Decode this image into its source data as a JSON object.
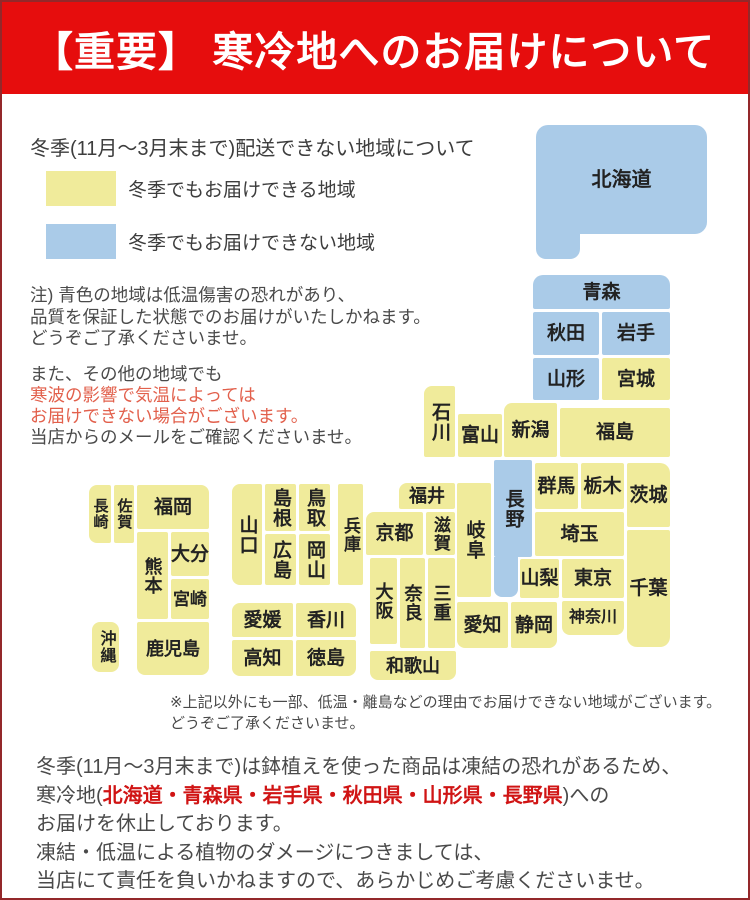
{
  "page": {
    "bg": "#ffffff",
    "border_color": "#93282a"
  },
  "banner": {
    "text": "【重要】 寒冷地へのお届けについて",
    "bg": "#e60d0d",
    "fg": "#ffffff"
  },
  "intro_title": "冬季(11月〜3月末まで)配送できない地域について",
  "legend": {
    "items": [
      {
        "color": "#f0eb9b",
        "label": "冬季でもお届けできる地域"
      },
      {
        "color": "#aacbe8",
        "label": "冬季でもお届けできない地域"
      }
    ]
  },
  "note_quality": {
    "lines": [
      {
        "parts": [
          {
            "t": "注) 青色の地域は低温傷害の恐れがあり、"
          }
        ]
      },
      {
        "parts": [
          {
            "t": "品質を保証した状態でのお届けがいたしかねます。"
          }
        ]
      },
      {
        "parts": [
          {
            "t": "どうぞご了承くださいませ。"
          }
        ]
      }
    ]
  },
  "note_coldwave": {
    "em_color": "#e2604c",
    "lines": [
      {
        "parts": [
          {
            "t": "また、その他の地域でも"
          }
        ]
      },
      {
        "parts": [
          {
            "t": "寒波の影響で気温によっては",
            "em": true
          }
        ]
      },
      {
        "parts": [
          {
            "t": "お届けできない場合がございます。",
            "em": true
          }
        ]
      },
      {
        "parts": [
          {
            "t": "当店からのメールをご確認くださいませ。"
          }
        ]
      }
    ]
  },
  "map": {
    "status_colors": {
      "ok": "#f0eb9b",
      "no": "#aacbe8"
    },
    "label_color": "#222222",
    "legend_meaning": {
      "ok": "冬季でもお届けできる地域",
      "no": "冬季でもお届けできない地域"
    },
    "blocks": [
      {
        "name": "hokkaido",
        "label": "北海道",
        "status": "no",
        "x": 534,
        "y": 123,
        "w": 171,
        "h": 109,
        "f": 20,
        "r": "12px"
      },
      {
        "name": "hokkaido-foot",
        "label": "",
        "status": "no",
        "x": 534,
        "y": 190,
        "w": 44,
        "h": 67,
        "r": "0 0 10px 10px"
      },
      {
        "name": "aomori",
        "label": "青森",
        "status": "no",
        "x": 531,
        "y": 273,
        "w": 137,
        "h": 34,
        "r": "10px 10px 2px 2px"
      },
      {
        "name": "akita",
        "label": "秋田",
        "status": "no",
        "x": 531,
        "y": 310,
        "w": 66,
        "h": 43
      },
      {
        "name": "iwate",
        "label": "岩手",
        "status": "no",
        "x": 600,
        "y": 310,
        "w": 68,
        "h": 43
      },
      {
        "name": "yamagata",
        "label": "山形",
        "status": "no",
        "x": 531,
        "y": 356,
        "w": 66,
        "h": 42
      },
      {
        "name": "miyagi",
        "label": "宮城",
        "status": "ok",
        "x": 600,
        "y": 356,
        "w": 68,
        "h": 42
      },
      {
        "name": "niigata",
        "label": "新潟",
        "status": "ok",
        "x": 502,
        "y": 401,
        "w": 53,
        "h": 54,
        "r": "8px 2px 2px 2px"
      },
      {
        "name": "fukushima",
        "label": "福島",
        "status": "ok",
        "x": 558,
        "y": 406,
        "w": 110,
        "h": 49
      },
      {
        "name": "toyama",
        "label": "富山",
        "status": "ok",
        "x": 456,
        "y": 412,
        "w": 44,
        "h": 43
      },
      {
        "name": "ishikawa",
        "label": "石川",
        "status": "ok",
        "x": 422,
        "y": 384,
        "w": 31,
        "h": 71,
        "v": true,
        "r": "8px 2px 2px 2px"
      },
      {
        "name": "gunma",
        "label": "群馬",
        "status": "ok",
        "x": 533,
        "y": 461,
        "w": 43,
        "h": 46
      },
      {
        "name": "tochigi",
        "label": "栃木",
        "status": "ok",
        "x": 579,
        "y": 461,
        "w": 43,
        "h": 46
      },
      {
        "name": "ibaraki",
        "label": "茨城",
        "status": "ok",
        "x": 625,
        "y": 461,
        "w": 43,
        "h": 64,
        "r": "2px 10px 2px 2px"
      },
      {
        "name": "saitama",
        "label": "埼玉",
        "status": "ok",
        "x": 533,
        "y": 510,
        "w": 89,
        "h": 44
      },
      {
        "name": "chiba",
        "label": "千葉",
        "status": "ok",
        "x": 625,
        "y": 528,
        "w": 43,
        "h": 117,
        "r": "2px 2px 10px 10px"
      },
      {
        "name": "yamanashi",
        "label": "山梨",
        "status": "ok",
        "x": 518,
        "y": 557,
        "w": 39,
        "h": 39
      },
      {
        "name": "tokyo",
        "label": "東京",
        "status": "ok",
        "x": 560,
        "y": 557,
        "w": 62,
        "h": 39
      },
      {
        "name": "kanagawa",
        "label": "神奈川",
        "status": "ok",
        "x": 560,
        "y": 599,
        "w": 62,
        "h": 34,
        "f": 16,
        "r": "2px 2px 8px 8px"
      },
      {
        "name": "nagano",
        "label": "長野",
        "status": "no",
        "x": 492,
        "y": 458,
        "w": 38,
        "h": 97,
        "v": true
      },
      {
        "name": "nagano-south",
        "label": "",
        "status": "no",
        "x": 492,
        "y": 555,
        "w": 24,
        "h": 40,
        "r": "0 0 8px 8px"
      },
      {
        "name": "gifu",
        "label": "岐阜",
        "status": "ok",
        "x": 455,
        "y": 481,
        "w": 34,
        "h": 114,
        "v": true
      },
      {
        "name": "fukui",
        "label": "福井",
        "status": "ok",
        "x": 397,
        "y": 481,
        "w": 56,
        "h": 26,
        "f": 18,
        "r": "8px 2px 2px 2px"
      },
      {
        "name": "kyoto",
        "label": "京都",
        "status": "ok",
        "x": 364,
        "y": 510,
        "w": 57,
        "h": 43,
        "r": "8px 2px 2px 2px"
      },
      {
        "name": "shiga",
        "label": "滋賀",
        "status": "ok",
        "x": 424,
        "y": 510,
        "w": 29,
        "h": 43,
        "v": true,
        "f": 17
      },
      {
        "name": "osaka",
        "label": "大阪",
        "status": "ok",
        "x": 368,
        "y": 556,
        "w": 27,
        "h": 86,
        "v": true,
        "f": 18
      },
      {
        "name": "nara",
        "label": "奈良",
        "status": "ok",
        "x": 398,
        "y": 556,
        "w": 25,
        "h": 90,
        "v": true,
        "f": 18
      },
      {
        "name": "mie",
        "label": "三重",
        "status": "ok",
        "x": 426,
        "y": 556,
        "w": 27,
        "h": 90,
        "v": true,
        "f": 18
      },
      {
        "name": "wakayama",
        "label": "和歌山",
        "status": "ok",
        "x": 368,
        "y": 649,
        "w": 86,
        "h": 29,
        "f": 18,
        "r": "2px 2px 8px 8px"
      },
      {
        "name": "aichi",
        "label": "愛知",
        "status": "ok",
        "x": 455,
        "y": 600,
        "w": 51,
        "h": 46,
        "r": "2px 2px 2px 8px"
      },
      {
        "name": "shizuoka",
        "label": "静岡",
        "status": "ok",
        "x": 509,
        "y": 600,
        "w": 46,
        "h": 46,
        "r": "2px 2px 8px 2px"
      },
      {
        "name": "yamaguchi",
        "label": "山口",
        "status": "ok",
        "x": 230,
        "y": 482,
        "w": 30,
        "h": 101,
        "v": true,
        "r": "8px 2px 2px 8px"
      },
      {
        "name": "shimane",
        "label": "島根",
        "status": "ok",
        "x": 263,
        "y": 482,
        "w": 31,
        "h": 47,
        "v": true
      },
      {
        "name": "tottori",
        "label": "鳥取",
        "status": "ok",
        "x": 297,
        "y": 482,
        "w": 31,
        "h": 47,
        "v": true
      },
      {
        "name": "hiroshima",
        "label": "広島",
        "status": "ok",
        "x": 263,
        "y": 532,
        "w": 31,
        "h": 51,
        "v": true
      },
      {
        "name": "okayama",
        "label": "岡山",
        "status": "ok",
        "x": 297,
        "y": 532,
        "w": 31,
        "h": 51,
        "v": true
      },
      {
        "name": "hyogo",
        "label": "兵庫",
        "status": "ok",
        "x": 336,
        "y": 482,
        "w": 25,
        "h": 101,
        "v": true,
        "f": 17
      },
      {
        "name": "ehime",
        "label": "愛媛",
        "status": "ok",
        "x": 230,
        "y": 601,
        "w": 61,
        "h": 34,
        "r": "8px 2px 2px 2px"
      },
      {
        "name": "kagawa",
        "label": "香川",
        "status": "ok",
        "x": 294,
        "y": 601,
        "w": 60,
        "h": 34,
        "r": "2px 8px 2px 2px"
      },
      {
        "name": "kochi",
        "label": "高知",
        "status": "ok",
        "x": 230,
        "y": 638,
        "w": 61,
        "h": 36,
        "r": "2px 2px 2px 8px"
      },
      {
        "name": "tokushima",
        "label": "徳島",
        "status": "ok",
        "x": 294,
        "y": 638,
        "w": 60,
        "h": 36,
        "r": "2px 2px 8px 2px"
      },
      {
        "name": "nagasaki",
        "label": "長崎",
        "status": "ok",
        "x": 87,
        "y": 483,
        "w": 22,
        "h": 58,
        "v": true,
        "f": 15,
        "r": "8px 2px 2px 8px"
      },
      {
        "name": "saga",
        "label": "佐賀",
        "status": "ok",
        "x": 112,
        "y": 483,
        "w": 20,
        "h": 58,
        "v": true,
        "f": 15
      },
      {
        "name": "fukuoka",
        "label": "福岡",
        "status": "ok",
        "x": 135,
        "y": 483,
        "w": 72,
        "h": 44,
        "r": "2px 8px 2px 2px"
      },
      {
        "name": "kumamoto",
        "label": "熊本",
        "status": "ok",
        "x": 135,
        "y": 530,
        "w": 31,
        "h": 87,
        "v": true,
        "f": 18
      },
      {
        "name": "oita",
        "label": "大分",
        "status": "ok",
        "x": 169,
        "y": 530,
        "w": 38,
        "h": 44
      },
      {
        "name": "miyazaki",
        "label": "宮崎",
        "status": "ok",
        "x": 169,
        "y": 577,
        "w": 38,
        "h": 40,
        "f": 17
      },
      {
        "name": "kagoshima",
        "label": "鹿児島",
        "status": "ok",
        "x": 135,
        "y": 620,
        "w": 72,
        "h": 53,
        "f": 18,
        "r": "2px 2px 8px 8px"
      },
      {
        "name": "okinawa",
        "label": "沖縄",
        "status": "ok",
        "x": 90,
        "y": 620,
        "w": 27,
        "h": 50,
        "v": true,
        "f": 16,
        "r": "8px"
      }
    ]
  },
  "footnote": {
    "lines": [
      {
        "parts": [
          {
            "t": "※上記以外にも一部、低温・離島などの理由でお届けできない地域がございます。"
          }
        ]
      },
      {
        "parts": [
          {
            "t": "どうぞご了承くださいませ。"
          }
        ]
      }
    ]
  },
  "bottom_notice": {
    "em_color": "#d01414",
    "lines": [
      {
        "parts": [
          {
            "t": "冬季(11月〜3月末まで)は鉢植えを使った商品は凍結の恐れがあるため、"
          }
        ]
      },
      {
        "parts": [
          {
            "t": "寒冷地("
          },
          {
            "t": "北海道・青森県・岩手県・秋田県・山形県・長野県",
            "em": true
          },
          {
            "t": ")への"
          }
        ]
      },
      {
        "parts": [
          {
            "t": "お届けを休止しております。"
          }
        ]
      },
      {
        "parts": [
          {
            "t": "凍結・低温による植物のダメージにつきましては、"
          }
        ]
      },
      {
        "parts": [
          {
            "t": "当店にて責任を負いかねますので、あらかじめご考慮くださいませ。"
          }
        ]
      }
    ]
  }
}
